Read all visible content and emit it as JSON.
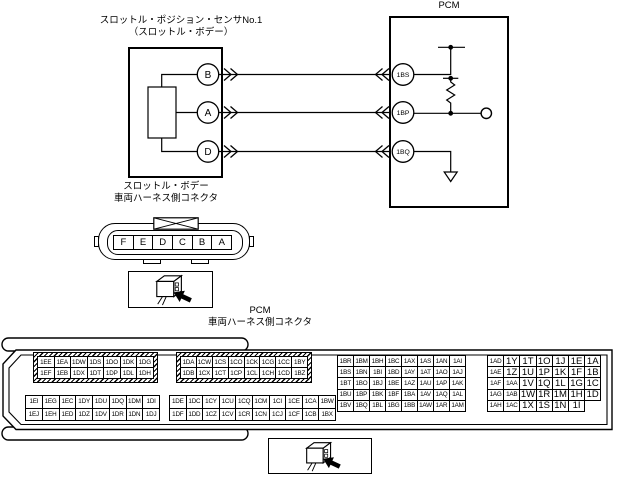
{
  "schematic": {
    "sensor": {
      "title_line1": "スロットル・ポジション・センサNo.1",
      "title_line2": "（スロットル・ボデー）",
      "pins": [
        "B",
        "A",
        "D"
      ],
      "caption_line1": "スロットル・ボデー",
      "caption_line2": "車両ハーネス側コネクタ"
    },
    "pcm": {
      "title": "PCM",
      "pins": [
        "1BS",
        "1BP",
        "1BQ"
      ]
    }
  },
  "sensor_connector": {
    "cells": [
      "F",
      "E",
      "D",
      "C",
      "B",
      "A"
    ]
  },
  "pcm_connector": {
    "title": "PCM",
    "caption": "車両ハーネス側コネクタ",
    "group1_top": [
      [
        "1EE",
        "1EA",
        "1DW",
        "1DS",
        "1DO",
        "1DK",
        "1DG"
      ],
      [
        "1EF",
        "1EB",
        "1DX",
        "1DT",
        "1DP",
        "1DL",
        "1DH"
      ]
    ],
    "group1_bottom": [
      [
        "1EI",
        "1EG",
        "1EC",
        "1DY",
        "1DU",
        "1DQ",
        "1DM",
        "1DI"
      ],
      [
        "1EJ",
        "1EH",
        "1ED",
        "1DZ",
        "1DV",
        "1DR",
        "1DN",
        "1DJ"
      ]
    ],
    "group2_top": [
      [
        "1DA",
        "1CW",
        "1CS",
        "1CO",
        "1CK",
        "1CG",
        "1CC",
        "1BY"
      ],
      [
        "1DB",
        "1CX",
        "1CT",
        "1CP",
        "1CL",
        "1CH",
        "1CD",
        "1BZ"
      ]
    ],
    "group2_bottom": [
      [
        "1DE",
        "1DC",
        "1CY",
        "1CU",
        "1CQ",
        "1CM",
        "1CI",
        "1CE",
        "1CA",
        "1BW"
      ],
      [
        "1DF",
        "1DD",
        "1CZ",
        "1CV",
        "1CR",
        "1CN",
        "1CJ",
        "1CF",
        "1CB",
        "1BX"
      ]
    ],
    "group3": [
      [
        "1BR",
        "1BM",
        "1BH",
        "1BC",
        "1AX",
        "1AS",
        "1AN",
        "1AI"
      ],
      [
        "1BS",
        "1BN",
        "1BI",
        "1BD",
        "1AY",
        "1AT",
        "1AO",
        "1AJ"
      ],
      [
        "1BT",
        "1BO",
        "1BJ",
        "1BE",
        "1AZ",
        "1AU",
        "1AP",
        "1AK"
      ],
      [
        "1BU",
        "1BP",
        "1BK",
        "1BF",
        "1BA",
        "1AV",
        "1AQ",
        "1AL"
      ],
      [
        "1BV",
        "1BQ",
        "1BL",
        "1BG",
        "1BB",
        "1AW",
        "1AR",
        "1AM"
      ]
    ],
    "group4": [
      [
        "1AD",
        "1Y",
        "1T",
        "1O",
        "1J",
        "1E",
        "1A"
      ],
      [
        "1AE",
        "1Z",
        "1U",
        "1P",
        "1K",
        "1F",
        "1B"
      ],
      [
        "1AF",
        "1AA",
        "1V",
        "1Q",
        "1L",
        "1G",
        "1C"
      ],
      [
        "1AG",
        "1AB",
        "1W",
        "1R",
        "1M",
        "1H",
        "1D"
      ],
      [
        "1AH",
        "1AC",
        "1X",
        "1S",
        "1N",
        "1I"
      ]
    ]
  },
  "colors": {
    "line": "#000000",
    "background": "#ffffff"
  }
}
